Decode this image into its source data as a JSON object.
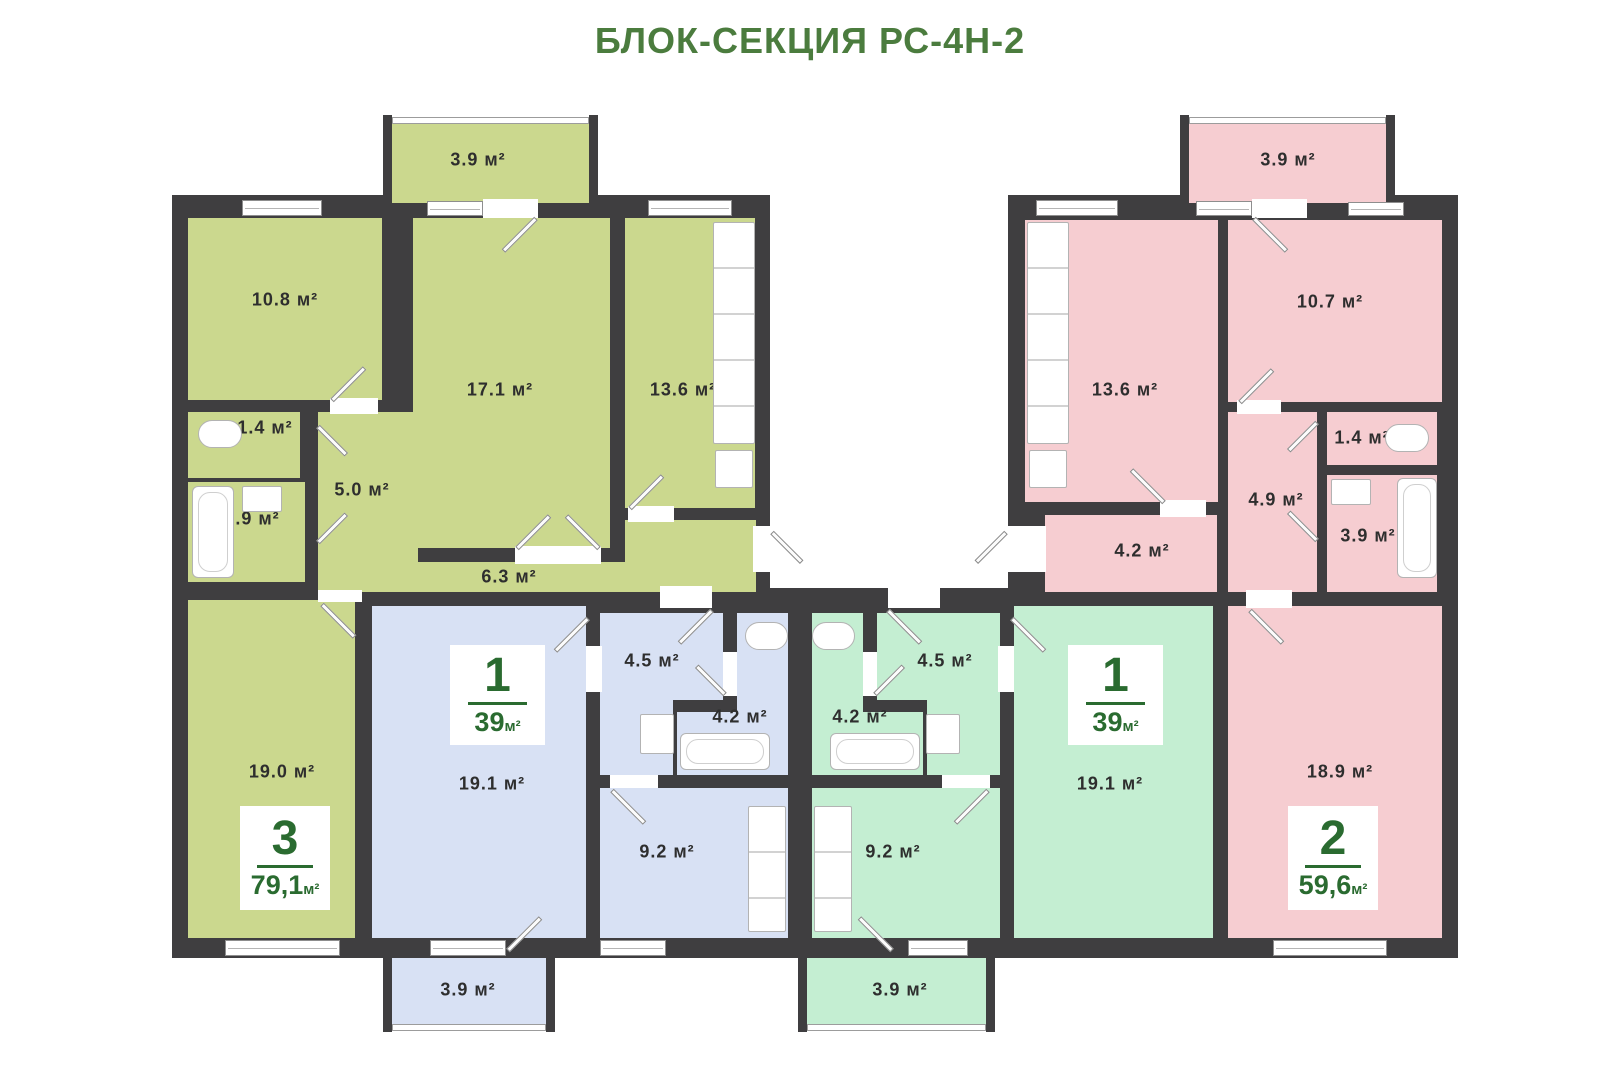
{
  "title": "БЛОК-СЕКЦИЯ РС-4Н-2",
  "colors": {
    "olive": "#cbd88e",
    "blue": "#d8e1f4",
    "mint": "#c4eed2",
    "pink": "#f6cdd1",
    "wall": "#3f3e40",
    "green": "#2a6b30",
    "title_green": "#4b7c3e"
  },
  "apartments": {
    "olive": {
      "badge": {
        "rooms": "3",
        "area": "79,1",
        "unit": "м²"
      },
      "labels": {
        "balcony": "3.9 м²",
        "bedroom1": "10.8 м²",
        "living": "17.1 м²",
        "kitchen": "13.6 м²",
        "wc": "1.4 м²",
        "hall": "5.0 м²",
        "bath": "3.9 м²",
        "corridor": "6.3 м²",
        "bedroom2": "19.0 м²"
      }
    },
    "blue": {
      "badge": {
        "rooms": "1",
        "area": "39",
        "unit": "м²"
      },
      "labels": {
        "living": "19.1 м²",
        "hall": "4.5 м²",
        "bath": "4.2 м²",
        "kitchen": "9.2 м²",
        "balcony": "3.9 м²"
      }
    },
    "mint": {
      "badge": {
        "rooms": "1",
        "area": "39",
        "unit": "м²"
      },
      "labels": {
        "living": "19.1 м²",
        "hall": "4.5 м²",
        "bath": "4.2 м²",
        "kitchen": "9.2 м²",
        "balcony": "3.9 м²"
      }
    },
    "pink": {
      "badge": {
        "rooms": "2",
        "area": "59,6",
        "unit": "м²"
      },
      "labels": {
        "balcony": "3.9 м²",
        "kitchen": "13.6 м²",
        "bedroom": "10.7 м²",
        "wc": "1.4 м²",
        "hall": "4.9 м²",
        "corridor": "4.2 м²",
        "bath": "3.9 м²",
        "living": "18.9 м²"
      }
    }
  }
}
